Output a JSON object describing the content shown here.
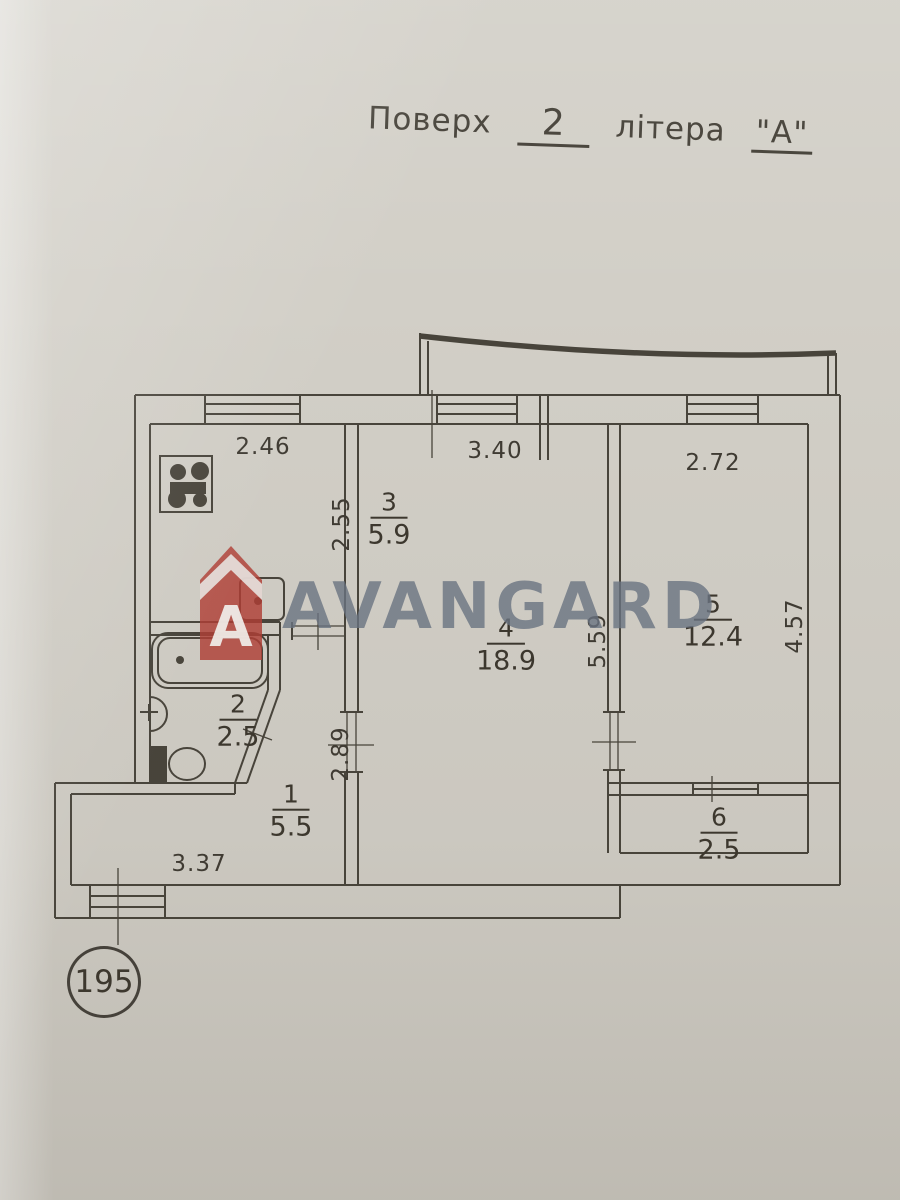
{
  "title": {
    "word_floor": "Поверх",
    "floor_value": "2",
    "word_letter": "літера",
    "letter_value": "\"А\""
  },
  "watermark": {
    "brand": "AVANGARD",
    "logo_letter": "A"
  },
  "plan_number": "195",
  "rooms": {
    "r1": {
      "num": "1",
      "area": "5.5"
    },
    "r2": {
      "num": "2",
      "area": "2.5"
    },
    "r3": {
      "num": "3",
      "area": "5.9"
    },
    "r4": {
      "num": "4",
      "area": "18.9"
    },
    "r5": {
      "num": "5",
      "area": "12.4"
    },
    "r6": {
      "num": "6",
      "area": "2.5"
    }
  },
  "dimensions": {
    "kitchen_width": "2.46",
    "kitchen_depth": "2.55",
    "room4_width": "3.40",
    "room5_width": "2.72",
    "room5_depth": "4.57",
    "room4_depth": "5.59",
    "hall_depth": "2.89",
    "hall_width": "3.37"
  },
  "colors": {
    "paper": "#d2cfc7",
    "ink": "#48443b",
    "watermark_text": "#6a7483",
    "logo_red": "#b23e36"
  }
}
